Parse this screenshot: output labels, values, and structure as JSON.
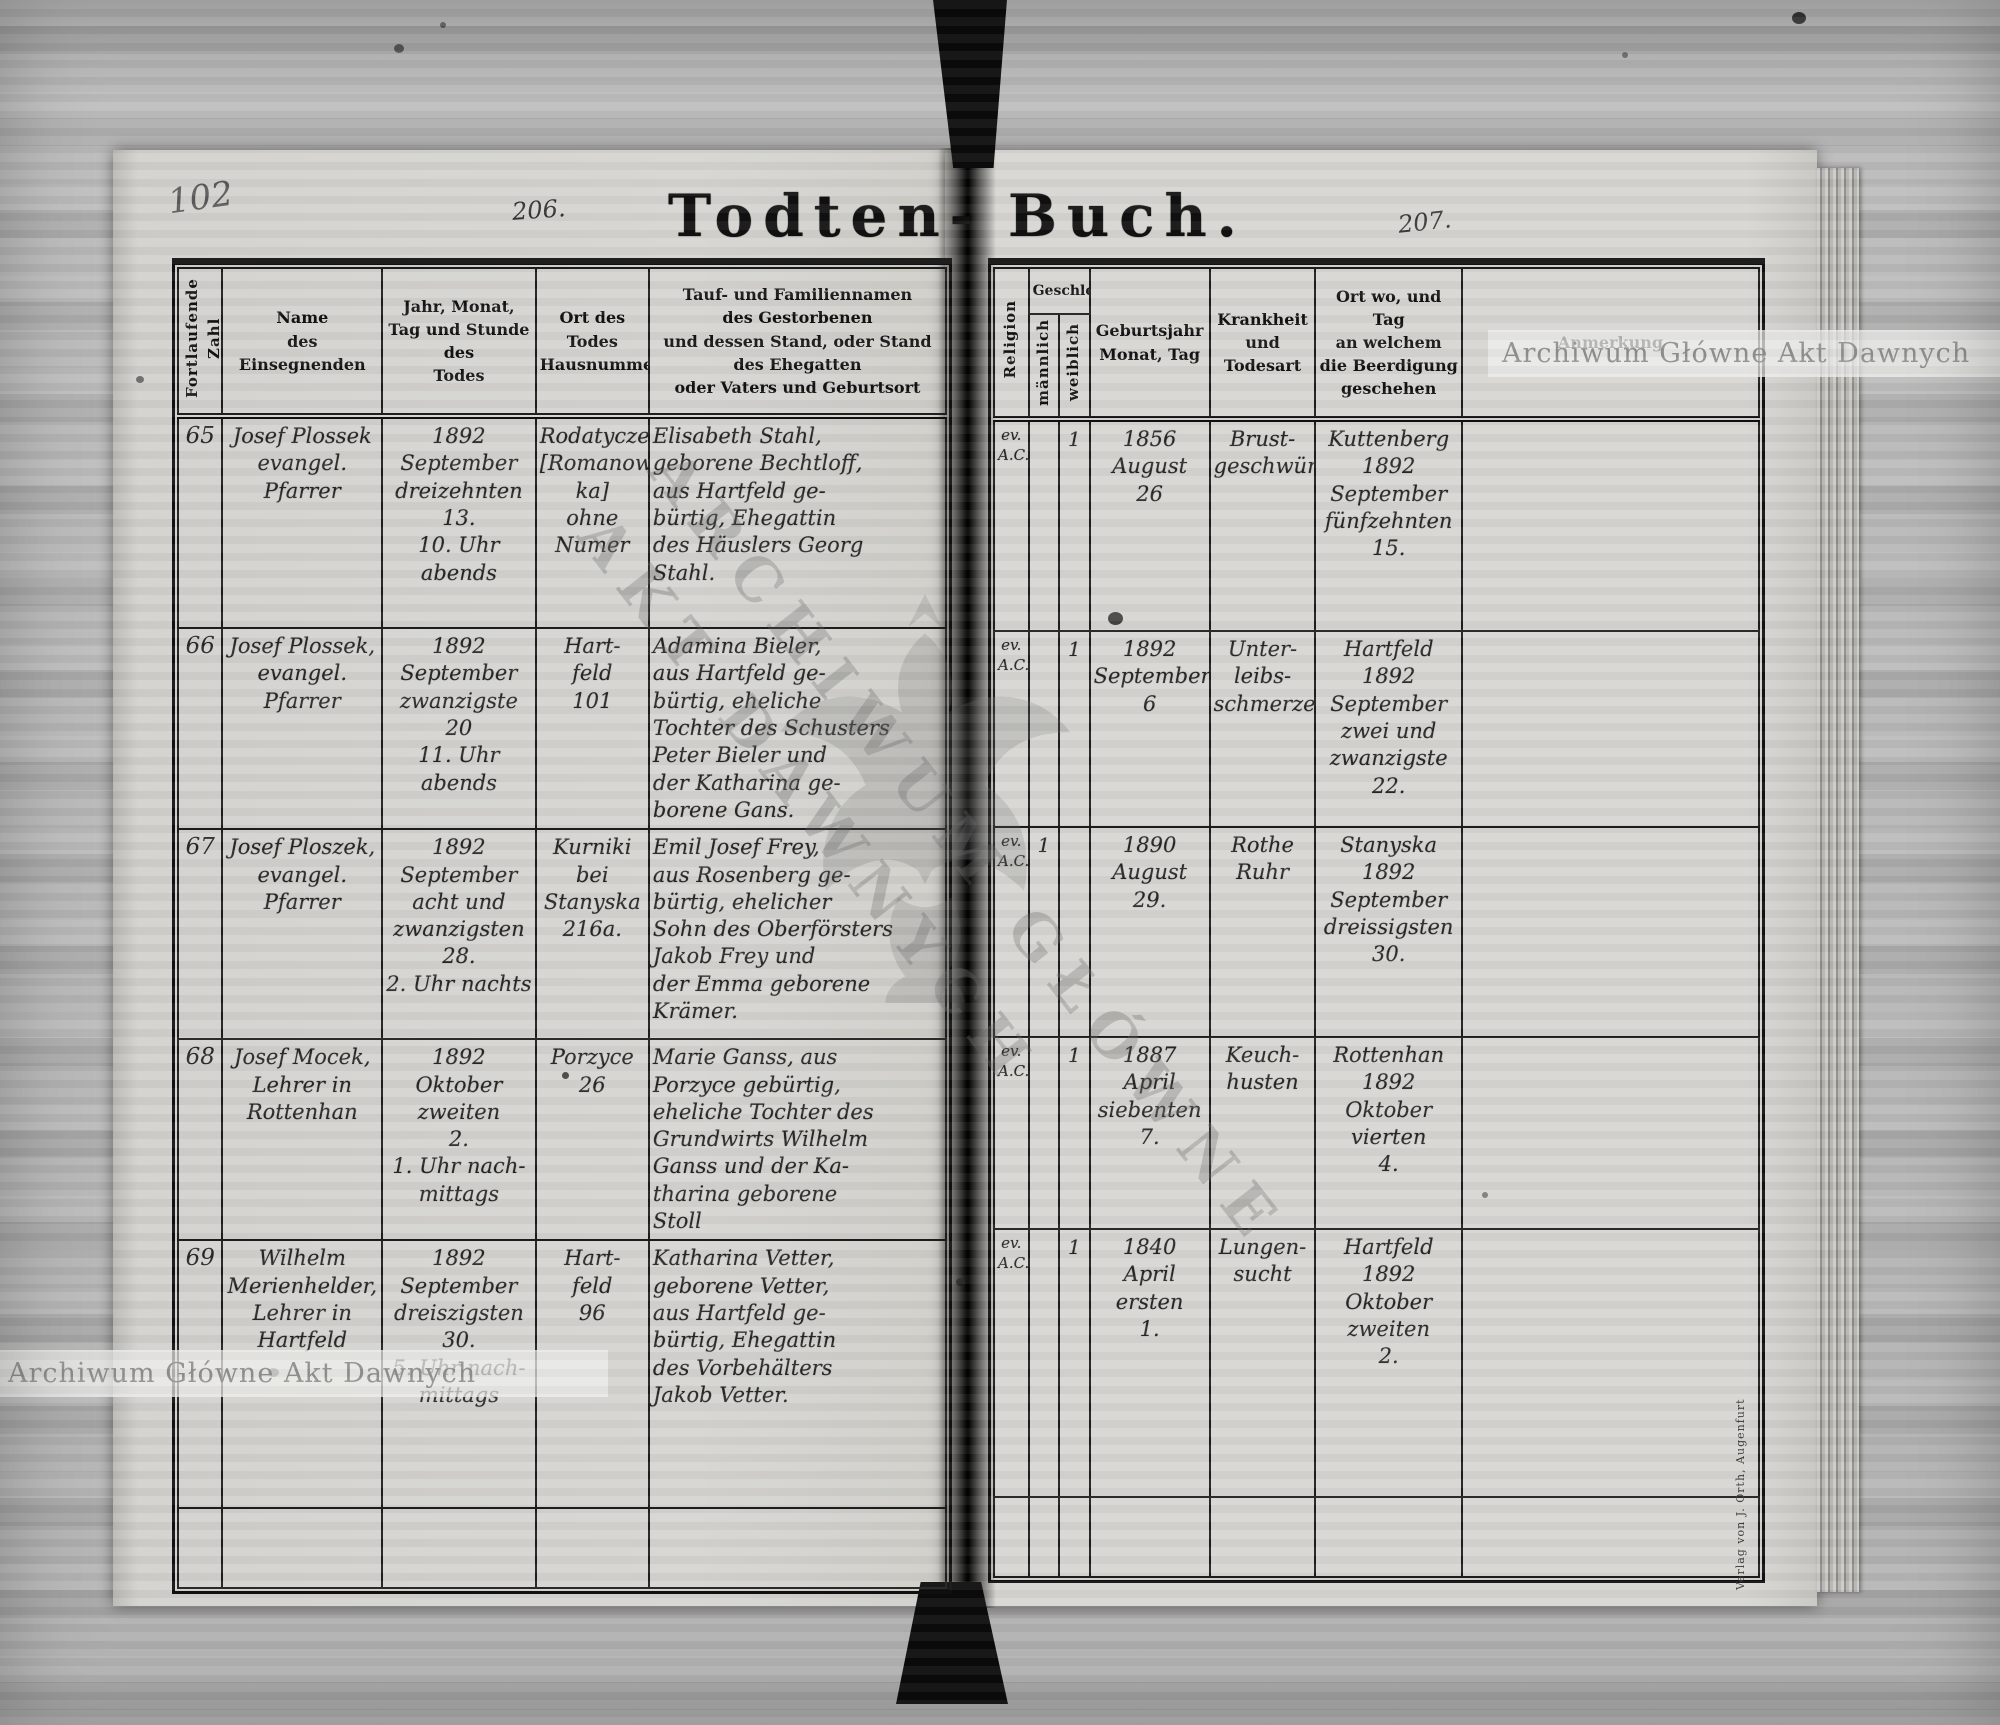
{
  "book": {
    "title_left": "Todten-",
    "title_right": "Buch.",
    "pencil_page_number": "102",
    "folio_left": "206.",
    "folio_right": "207.",
    "imprint": "Verlag von J. Orth, Augenfurt"
  },
  "watermarks": {
    "bar_text": "Archiwum Główne Akt Dawnych",
    "diagonal_line1": "ARCHIWUM GŁÓWNE",
    "diagonal_line2": "AKT DAWNYCH"
  },
  "headers": {
    "zahl": "Fortlaufende Zahl",
    "name": "Name\ndes\nEinsegnenden",
    "death": "Jahr, Monat,\nTag und Stunde des\nTodes",
    "place": "Ort des Todes\nHausnummer",
    "deceased": "Tauf- und Familiennamen\ndes Gestorbenen\nund dessen Stand, oder Stand des Ehegatten\noder Vaters und Geburtsort",
    "religion": "Religion",
    "sex": "Geschlecht",
    "male": "männlich",
    "female": "weiblich",
    "birth": "Geburtsjahr\nMonat, Tag",
    "disease": "Krankheit\nund\nTodesart",
    "burial": "Ort wo, und Tag\nan welchem die Beerdigung\ngeschehen",
    "note": "Anmerkung"
  },
  "rows": [
    {
      "nr": "65",
      "name": "Josef Plossek\nevangel.\nPfarrer",
      "death": "1892\nSeptember\ndreizehnten\n13.\n10. Uhr abends",
      "place": "Rodatycze\n[Romanow-\nka]\nohne Numer",
      "deceased": "Elisabeth Stahl,\ngeborene Bechtloff,\naus Hartfeld ge-\nbürtig, Ehegattin\ndes Häuslers Georg\nStahl.",
      "religion": "ev.\nA.C.",
      "male": "",
      "female": "1",
      "birth": "1856\nAugust\n26",
      "disease": "Brust-\ngeschwüre",
      "burial": "Kuttenberg\n1892\nSeptember\nfünfzehnten\n15.",
      "note": ""
    },
    {
      "nr": "66",
      "name": "Josef Plossek,\nevangel.\nPfarrer",
      "death": "1892\nSeptember\nzwanzigste\n20\n11. Uhr abends",
      "place": "Hart-\nfeld\n101",
      "deceased": "Adamina Bieler,\naus Hartfeld ge-\nbürtig, eheliche\nTochter des Schusters\nPeter Bieler und\nder Katharina ge-\nborene Gans.",
      "religion": "ev.\nA.C.",
      "male": "",
      "female": "1",
      "birth": "1892\nSeptember\n6",
      "disease": "Unter-\nleibs-\nschmerzen",
      "burial": "Hartfeld\n1892\nSeptember\nzwei und\nzwanzigste\n22.",
      "note": ""
    },
    {
      "nr": "67",
      "name": "Josef Ploszek,\nevangel.\nPfarrer",
      "death": "1892\nSeptember\nacht und\nzwanzigsten\n28.\n2. Uhr nachts",
      "place": "Kurniki\nbei\nStanyska\n216a.",
      "deceased": "Emil Josef Frey,\naus Rosenberg ge-\nbürtig, ehelicher\nSohn des Oberförsters\nJakob Frey und\nder Emma geborene\nKrämer.",
      "religion": "ev.\nA.C.",
      "male": "1",
      "female": "",
      "birth": "1890\nAugust\n29.",
      "disease": "Rothe\nRuhr",
      "burial": "Stanyska\n1892\nSeptember\ndreissigsten\n30.",
      "note": ""
    },
    {
      "nr": "68",
      "name": "Josef Mocek,\nLehrer in\nRottenhan",
      "death": "1892\nOktober\nzweiten\n2.\n1. Uhr nach-\nmittags",
      "place": "Porzyce\n26",
      "deceased": "Marie Ganss, aus\nPorzyce gebürtig,\neheliche Tochter des\nGrundwirts Wilhelm\nGanss und der Ka-\ntharina geborene\nStoll",
      "religion": "ev.\nA.C.",
      "male": "",
      "female": "1",
      "birth": "1887\nApril\nsiebenten\n7.",
      "disease": "Keuch-\nhusten",
      "burial": "Rottenhan\n1892\nOktober\nvierten\n4.",
      "note": ""
    },
    {
      "nr": "69",
      "name": "Wilhelm\nMerienhelder,\nLehrer in\nHartfeld",
      "death": "1892\nSeptember\ndreiszigsten\n30.\n5. Uhr nach-\nmittags",
      "place": "Hart-\nfeld\n96",
      "deceased": "Katharina Vetter,\ngeborene Vetter,\naus Hartfeld ge-\nbürtig, Ehegattin\ndes Vorbehälters\nJakob Vetter.",
      "religion": "ev.\nA.C.",
      "male": "",
      "female": "1",
      "birth": "1840\nApril\nersten\n1.",
      "disease": "Lungen-\nsucht",
      "burial": "Hartfeld\n1892\nOktober\nzweiten\n2.",
      "note": ""
    }
  ]
}
